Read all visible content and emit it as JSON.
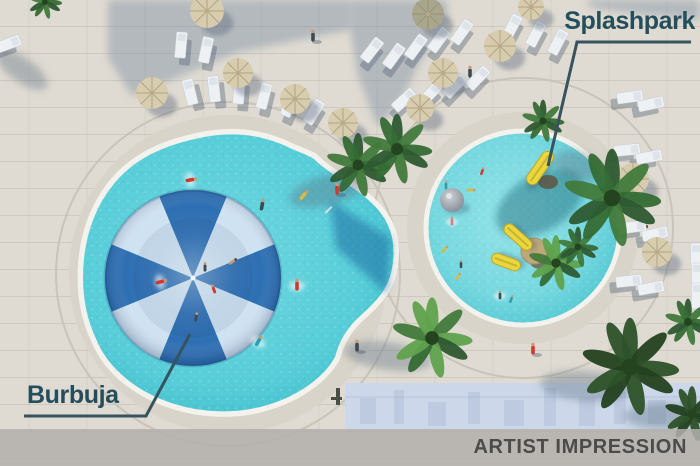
{
  "labels": {
    "splashpark": "Splashpark",
    "burbuja": "Burbuja"
  },
  "footer": {
    "text": "ARTIST IMPRESSION"
  },
  "colors": {
    "pavement": "#dfdbd2",
    "pavement_ring": "#d8d4c9",
    "grout_line": "#c9c4b9",
    "coping": "#f3f2ec",
    "big_pool_water": [
      "#6fd7e0",
      "#57cdd8",
      "#3dbcca"
    ],
    "splash_pool_water": [
      "#96e4e9",
      "#77d8df",
      "#4fc6d2"
    ],
    "umbrella_dark": "#2e6fb3",
    "umbrella_light": "#cfe2f1",
    "label_text": "#254e5c",
    "annotation_line": "#36535e",
    "footer_bar": "#b2b0ac",
    "footer_text": "#4b4b49",
    "facade": "#ccd8ea",
    "facade_detail": "#b7c5dc",
    "slide_yellow": "#ead73f",
    "palm_greens": [
      "#2d5a30",
      "#417a3b",
      "#356b34",
      "#5fa24d"
    ],
    "people": {
      "red": "#cf3a2c",
      "teal": "#2f9fae",
      "dark": "#3d4b54",
      "yellow": "#d9ba3e",
      "pink": "#d77b8a",
      "skin": "#c89a74"
    }
  },
  "scene": {
    "big_pool": {
      "cx": 228,
      "cy": 274,
      "ring_r": 159,
      "arc_r": 172,
      "path": "M 200,135 C 238,127 268,134 292,146 C 306,152 314,154 319,160 C 332,172 352,182 369,197 C 389,214 398,233 396,259 C 394,287 381,301 363,317 C 349,329 341,344 338,357 C 327,379 297,402 255,411 C 192,424 117,396 94,341 C 73,297 77,239 100,199 C 124,158 161,143 200,135 Z",
      "deep_wedge": "M 330,200 L 391,239 L 387,293 L 336,248 Z",
      "ladder": {
        "x": 331,
        "y": 206
      }
    },
    "splash_pool": {
      "cx": 523,
      "cy": 228,
      "r": 97,
      "ring_r": 116,
      "arc_r": 150
    },
    "umbrella": {
      "cx": 193,
      "cy": 278,
      "r": 88,
      "wedges": 8
    },
    "shadow_polys": [
      "108,0 350,0 350,30 238,52 132,96 108,58",
      "350,0 447,0 448,22 420,62 400,102 378,128 358,76 350,28",
      "585,0 700,0 700,20 640,14 592,8"
    ],
    "facade": {
      "x": 345,
      "y": 383,
      "w": 355,
      "h": 47,
      "rects": [
        [
          360,
          398,
          16,
          26
        ],
        [
          394,
          390,
          10,
          34
        ],
        [
          428,
          402,
          18,
          24
        ],
        [
          468,
          392,
          12,
          32
        ],
        [
          504,
          400,
          20,
          26
        ],
        [
          544,
          388,
          12,
          38
        ],
        [
          579,
          398,
          16,
          28
        ],
        [
          614,
          392,
          12,
          32
        ],
        [
          648,
          400,
          18,
          24
        ],
        [
          680,
          390,
          12,
          34
        ]
      ],
      "marks": [
        [
          336,
          388,
          4,
          17
        ],
        [
          331,
          397,
          11,
          3
        ]
      ]
    },
    "loungers": [
      {
        "x": 181,
        "y": 45,
        "rot": 5
      },
      {
        "x": 206,
        "y": 50,
        "rot": 12
      },
      {
        "x": 8,
        "y": 44,
        "rot": 70
      },
      {
        "x": 190,
        "y": 92,
        "rot": -14
      },
      {
        "x": 214,
        "y": 89,
        "rot": -6
      },
      {
        "x": 239,
        "y": 91,
        "rot": 4
      },
      {
        "x": 264,
        "y": 96,
        "rot": 14
      },
      {
        "x": 290,
        "y": 104,
        "rot": 24
      },
      {
        "x": 314,
        "y": 112,
        "rot": 32
      },
      {
        "x": 372,
        "y": 50,
        "rot": 38
      },
      {
        "x": 394,
        "y": 56,
        "rot": 36
      },
      {
        "x": 416,
        "y": 47,
        "rot": 36
      },
      {
        "x": 439,
        "y": 40,
        "rot": 36
      },
      {
        "x": 462,
        "y": 32,
        "rot": 36
      },
      {
        "x": 512,
        "y": 27,
        "rot": 28
      },
      {
        "x": 536,
        "y": 34,
        "rot": 28
      },
      {
        "x": 558,
        "y": 42,
        "rot": 28
      },
      {
        "x": 404,
        "y": 100,
        "rot": 48
      },
      {
        "x": 430,
        "y": 94,
        "rot": 44
      },
      {
        "x": 455,
        "y": 86,
        "rot": 44
      },
      {
        "x": 478,
        "y": 78,
        "rot": 44
      },
      {
        "x": 630,
        "y": 97,
        "rot": 82
      },
      {
        "x": 651,
        "y": 104,
        "rot": 78
      },
      {
        "x": 627,
        "y": 150,
        "rot": 84
      },
      {
        "x": 649,
        "y": 157,
        "rot": 80
      },
      {
        "x": 633,
        "y": 227,
        "rot": 82
      },
      {
        "x": 655,
        "y": 234,
        "rot": 78
      },
      {
        "x": 629,
        "y": 281,
        "rot": 84
      },
      {
        "x": 651,
        "y": 288,
        "rot": 80
      },
      {
        "x": 696,
        "y": 256,
        "rot": 0
      },
      {
        "x": 697,
        "y": 276,
        "rot": 0
      },
      {
        "x": 697,
        "y": 296,
        "rot": 0
      }
    ],
    "parasols": [
      {
        "x": 207,
        "y": 11,
        "r": 17
      },
      {
        "x": 152,
        "y": 93,
        "r": 16
      },
      {
        "x": 238,
        "y": 73,
        "r": 15
      },
      {
        "x": 295,
        "y": 99,
        "r": 15
      },
      {
        "x": 343,
        "y": 123,
        "r": 15
      },
      {
        "x": 428,
        "y": 14,
        "r": 16,
        "olive": true
      },
      {
        "x": 500,
        "y": 46,
        "r": 16
      },
      {
        "x": 443,
        "y": 73,
        "r": 15
      },
      {
        "x": 420,
        "y": 108,
        "r": 14
      },
      {
        "x": 531,
        "y": 7,
        "r": 13
      },
      {
        "x": 633,
        "y": 179,
        "r": 16
      },
      {
        "x": 657,
        "y": 252,
        "r": 15
      }
    ],
    "palm_shadows": [
      {
        "x": 328,
        "y": 190,
        "rx": 40,
        "ry": 15,
        "rot": -15
      },
      {
        "x": 540,
        "y": 203,
        "rx": 48,
        "ry": 28,
        "rot": -30,
        "pool": true
      },
      {
        "x": 578,
        "y": 166,
        "rx": 26,
        "ry": 14,
        "rot": 20
      },
      {
        "x": 388,
        "y": 356,
        "rx": 44,
        "ry": 14,
        "rot": 8
      },
      {
        "x": 586,
        "y": 386,
        "rx": 46,
        "ry": 15,
        "rot": 4
      },
      {
        "x": 664,
        "y": 416,
        "rx": 40,
        "ry": 13,
        "rot": 0
      },
      {
        "x": 22,
        "y": 70,
        "rx": 30,
        "ry": 12,
        "rot": 35
      }
    ],
    "palms": [
      {
        "x": 358,
        "y": 165,
        "r": 30
      },
      {
        "x": 397,
        "y": 149,
        "r": 33
      },
      {
        "x": 612,
        "y": 198,
        "r": 46
      },
      {
        "x": 543,
        "y": 121,
        "r": 20
      },
      {
        "x": 432,
        "y": 338,
        "r": 38,
        "bright": true
      },
      {
        "x": 630,
        "y": 367,
        "r": 46,
        "dark": true
      },
      {
        "x": 688,
        "y": 322,
        "r": 22
      },
      {
        "x": 692,
        "y": 414,
        "r": 26,
        "dark": true
      },
      {
        "x": 45,
        "y": 2,
        "r": 16
      }
    ],
    "equipment": {
      "dome": {
        "x": 452,
        "y": 200,
        "r": 12
      },
      "slide_base": {
        "x": 548,
        "y": 182,
        "rx": 10,
        "ry": 7
      },
      "slides": [
        {
          "x": 540,
          "y": 168,
          "rot": 35,
          "len": 38,
          "w": 12
        },
        {
          "x": 518,
          "y": 237,
          "rot": -48,
          "len": 34,
          "w": 11
        },
        {
          "x": 506,
          "y": 262,
          "rot": -70,
          "len": 30,
          "w": 11
        }
      ],
      "hub": {
        "x": 534,
        "y": 251,
        "r": 13
      },
      "hub_canopy": {
        "x": 543,
        "y": 258,
        "rx": 14,
        "ry": 10,
        "rot": -25
      },
      "in_pool_palms": [
        {
          "x": 556,
          "y": 263,
          "r": 26,
          "bright": true
        },
        {
          "x": 578,
          "y": 247,
          "r": 19
        }
      ]
    },
    "people": [
      {
        "x": 190,
        "y": 180,
        "rot": 80,
        "c": "red",
        "splash": true
      },
      {
        "x": 160,
        "y": 282,
        "rot": 75,
        "c": "red",
        "splash": true
      },
      {
        "x": 297,
        "y": 286,
        "rot": 0,
        "c": "red",
        "splash": true
      },
      {
        "x": 258,
        "y": 342,
        "rot": 30,
        "c": "teal",
        "splash": true
      },
      {
        "x": 262,
        "y": 206,
        "rot": 10,
        "c": "dark"
      },
      {
        "x": 303,
        "y": 196,
        "rot": 40,
        "c": "yellow"
      },
      {
        "x": 205,
        "y": 268,
        "rot": 0,
        "c": "dark",
        "s": 0.8
      },
      {
        "x": 214,
        "y": 290,
        "rot": -20,
        "c": "red",
        "s": 0.8
      },
      {
        "x": 196,
        "y": 318,
        "rot": 10,
        "c": "dark",
        "s": 0.8
      },
      {
        "x": 232,
        "y": 262,
        "rot": 55,
        "c": "skin",
        "s": 0.8
      },
      {
        "x": 446,
        "y": 186,
        "rot": 0,
        "c": "teal",
        "s": 0.75
      },
      {
        "x": 470,
        "y": 190,
        "rot": 90,
        "c": "yellow",
        "s": 0.75
      },
      {
        "x": 452,
        "y": 222,
        "rot": 0,
        "c": "pink",
        "s": 0.75,
        "splash": true
      },
      {
        "x": 444,
        "y": 250,
        "rot": 45,
        "c": "yellow",
        "s": 0.75
      },
      {
        "x": 461,
        "y": 265,
        "rot": 0,
        "c": "dark",
        "s": 0.7
      },
      {
        "x": 458,
        "y": 277,
        "rot": 30,
        "c": "yellow",
        "s": 0.7
      },
      {
        "x": 500,
        "y": 296,
        "rot": 0,
        "c": "dark",
        "s": 0.75,
        "splash": true
      },
      {
        "x": 511,
        "y": 300,
        "rot": 20,
        "c": "teal",
        "s": 0.7
      },
      {
        "x": 482,
        "y": 172,
        "rot": 20,
        "c": "red",
        "s": 0.7
      },
      {
        "x": 337,
        "y": 190,
        "rot": 0,
        "c": "red",
        "shadow": true
      },
      {
        "x": 357,
        "y": 347,
        "rot": 0,
        "c": "dark",
        "shadow": true
      },
      {
        "x": 533,
        "y": 350,
        "rot": 0,
        "c": "red",
        "shadow": true
      },
      {
        "x": 313,
        "y": 37,
        "rot": 0,
        "c": "dark",
        "shadow": true
      },
      {
        "x": 470,
        "y": 73,
        "rot": 0,
        "c": "dark",
        "shadow": true
      },
      {
        "x": 641,
        "y": 228,
        "rot": 75,
        "c": "skin"
      }
    ],
    "annotation_lines": {
      "splashpark": "691,42 577,42 548,166",
      "burbuja": "24,416 146,416 190,334"
    }
  }
}
